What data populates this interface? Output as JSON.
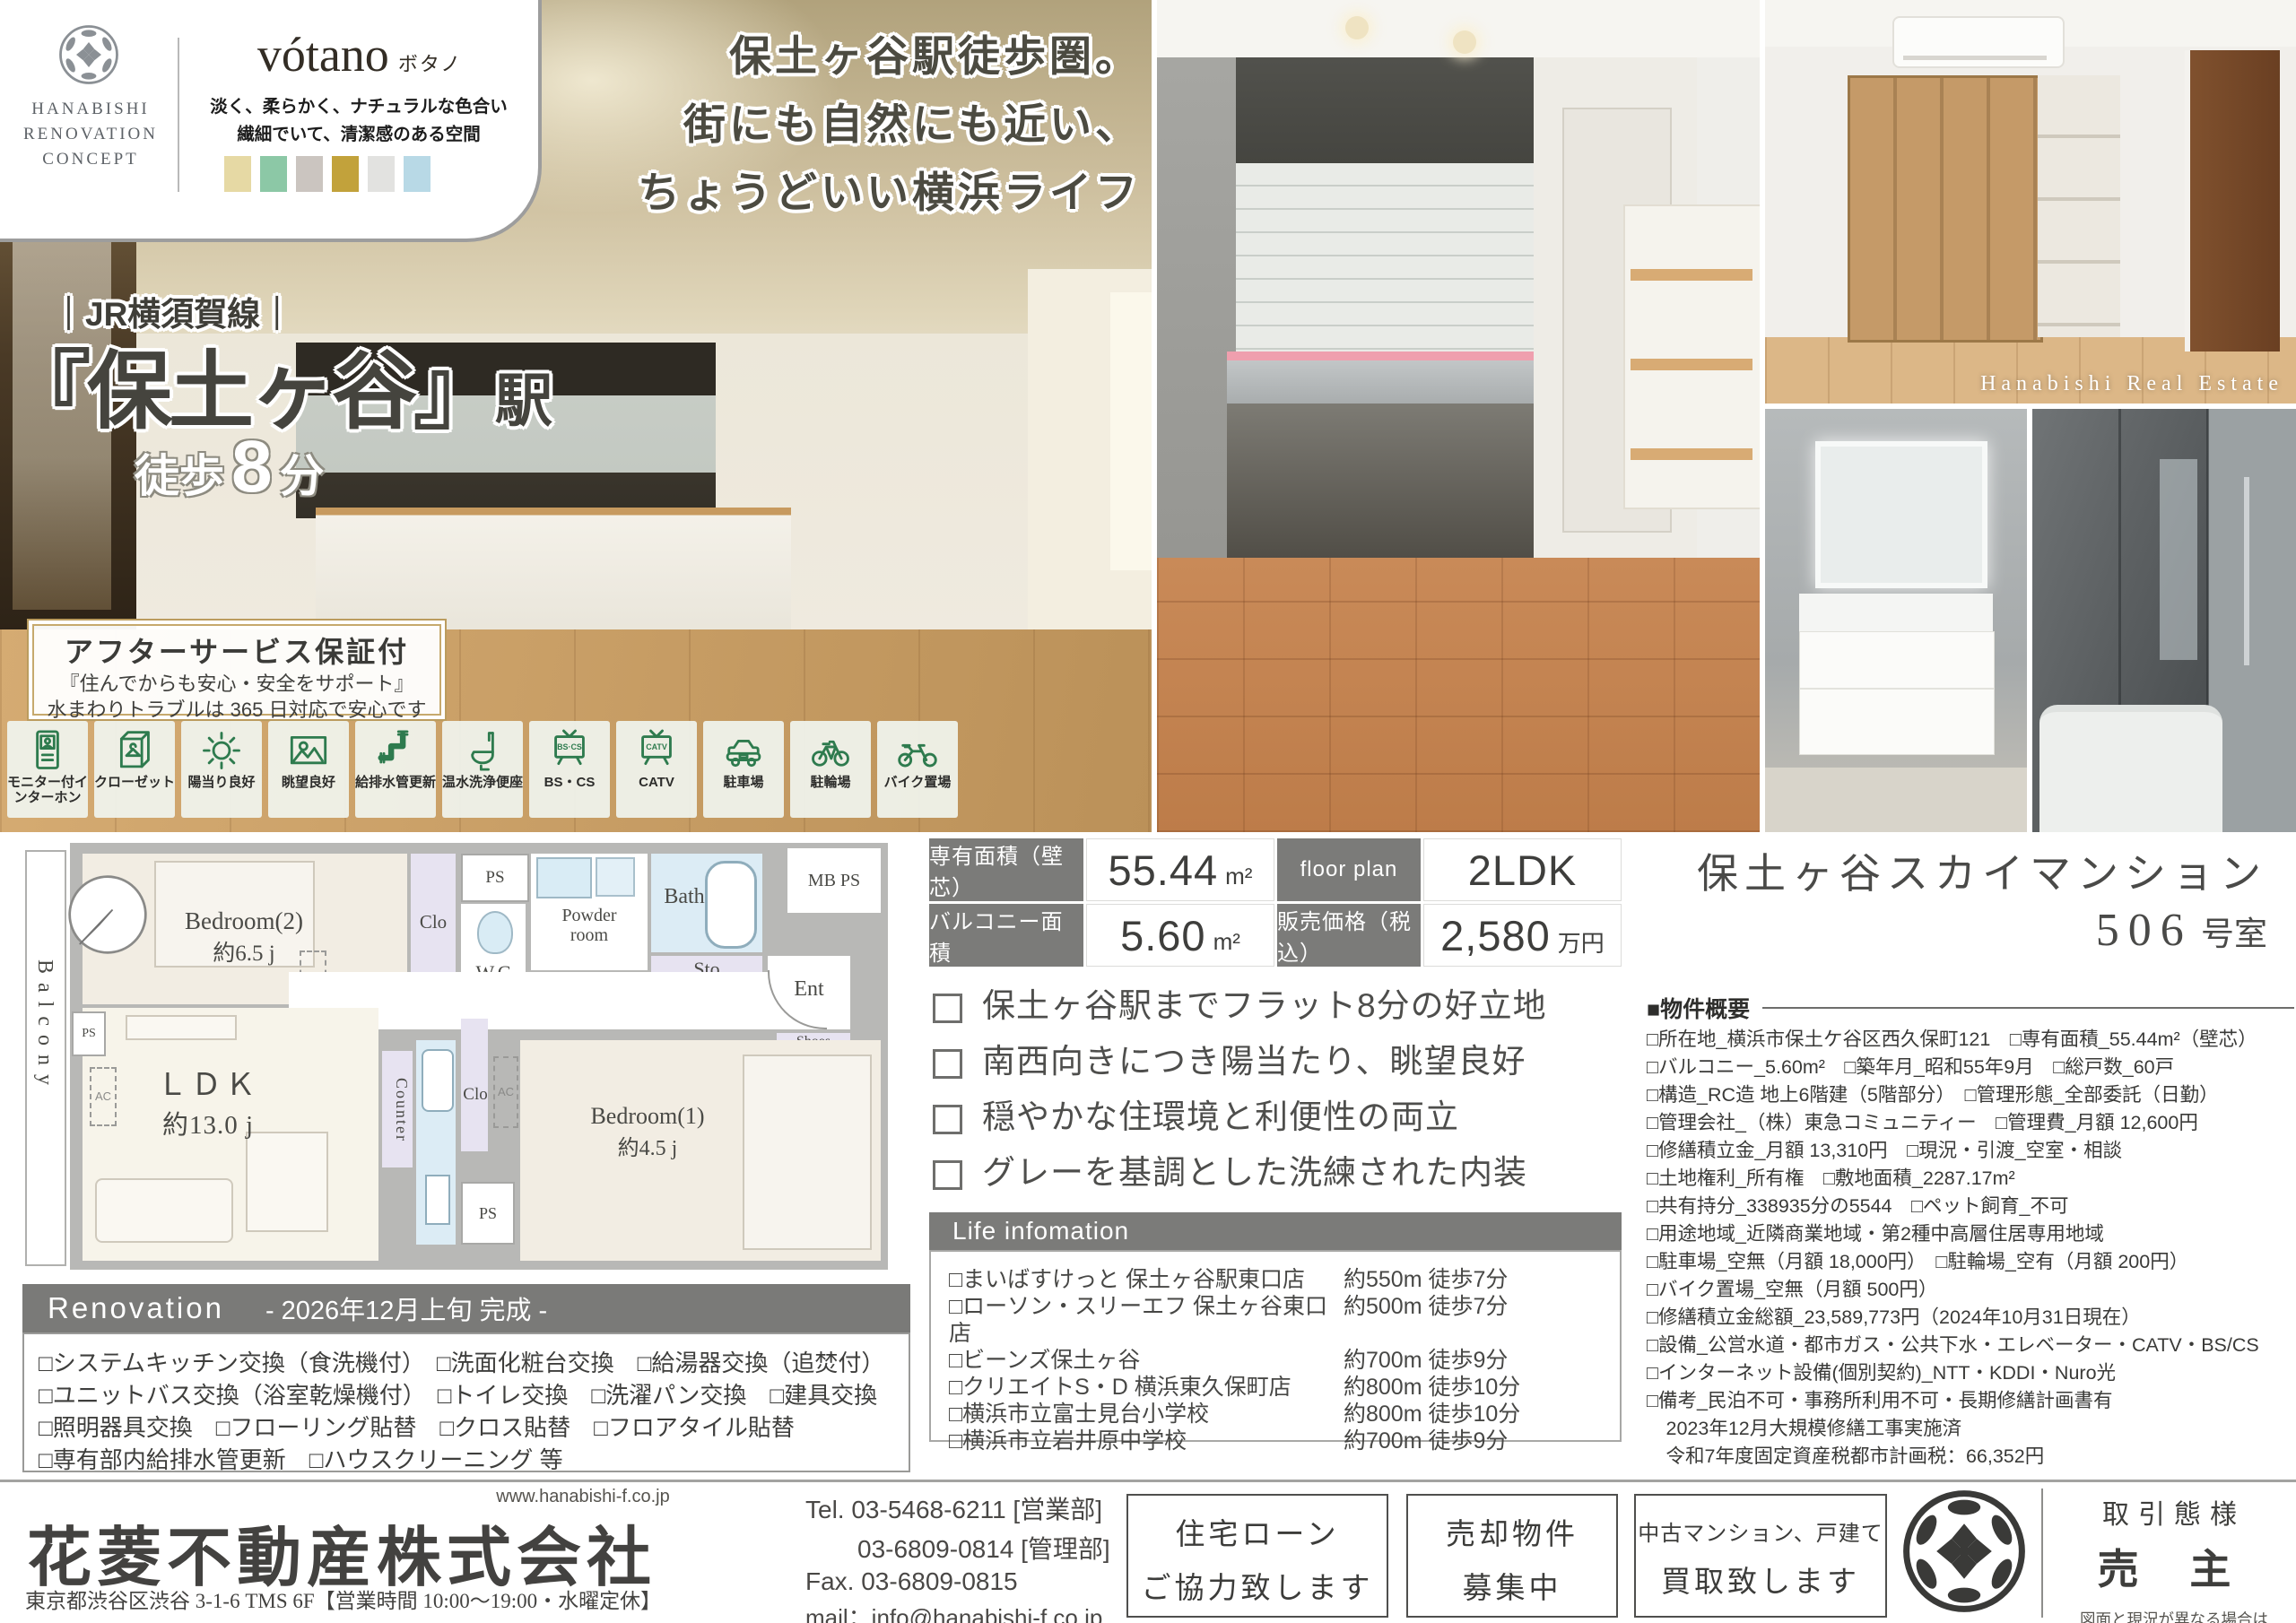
{
  "brand": {
    "logo_lines": [
      "HANABISHI",
      "RENOVATION",
      "CONCEPT"
    ],
    "concept_name": "vótano",
    "concept_kana": "ボタノ",
    "tagline1": "淡く、柔らかく、ナチュラルな色合い",
    "tagline2": "繊細でいて、清潔感のある空間",
    "swatches": [
      "#e6d9a4",
      "#8cc8a6",
      "#cbc5c0",
      "#c2a23b",
      "#e2e2e0",
      "#b8d9e6"
    ]
  },
  "station": {
    "line": "｜JR横須賀線｜",
    "name": "『保土ヶ谷』",
    "suffix": "駅",
    "walk_prefix": "徒歩",
    "walk_num": "8",
    "walk_suffix": "分"
  },
  "headline": {
    "line1": "保土ヶ谷駅徒歩圏。",
    "line2": "街にも自然にも近い、",
    "line3": "ちょうどいい横浜ライフ"
  },
  "warranty": {
    "title": "アフターサービス保証付",
    "sub1": "『住んでからも安心・安全をサポート』",
    "sub2": "水まわりトラブルは 365 日対応で安心です"
  },
  "feature_icons": [
    {
      "label": "モニター付インターホン",
      "icon": "intercom-icon"
    },
    {
      "label": "クローゼット",
      "icon": "closet-icon"
    },
    {
      "label": "陽当り良好",
      "icon": "sun-icon"
    },
    {
      "label": "眺望良好",
      "icon": "view-icon"
    },
    {
      "label": "給排水管更新",
      "icon": "pipe-icon"
    },
    {
      "label": "温水洗浄便座",
      "icon": "toilet-icon"
    },
    {
      "label": "BS・CS",
      "icon": "bscs-tv-icon",
      "tv_text": "BS·CS"
    },
    {
      "label": "CATV",
      "icon": "catv-tv-icon",
      "tv_text": "CATV"
    },
    {
      "label": "駐車場",
      "icon": "car-icon"
    },
    {
      "label": "駐輪場",
      "icon": "bicycle-icon"
    },
    {
      "label": "バイク置場",
      "icon": "motorcycle-icon"
    }
  ],
  "photo_watermark": "Hanabishi Real Estate",
  "floorplan": {
    "balcony": "Balcony",
    "bedroom2": "Bedroom(2)",
    "bedroom2_size": "約6.5 j",
    "clo": "Clo",
    "ps": "PS",
    "wc": "W.C",
    "powder1": "Powder",
    "powder2": "room",
    "bath": "Bath",
    "sto": "Sto",
    "mbps": "MB PS",
    "ent": "Ent",
    "shoes1": "Shoes",
    "shoes2": "box",
    "ldk": "ＬＤＫ",
    "ldk_size": "約13.0 j",
    "counter": "Counter",
    "clo2": "Clo",
    "ac": "AC",
    "bedroom1": "Bedroom(1)",
    "bedroom1_size": "約4.5 j"
  },
  "renovation": {
    "title": "Renovation",
    "subtitle": "- 2026年12月上旬 完成 -",
    "rows": [
      "□システムキッチン交換（食洗機付）　□洗面化粧台交換　□給湯器交換（追焚付）",
      "□ユニットバス交換（浴室乾燥機付）　□トイレ交換　□洗濯パン交換　□建具交換",
      "□照明器具交換　□フローリング貼替　□クロス貼替　□フロアタイル貼替",
      "□専有部内給排水管更新　□ハウスクリーニング 等"
    ]
  },
  "specs": {
    "area_label": "専有面積（壁芯）",
    "area_value": "55.44",
    "area_unit": "m²",
    "plan_label": "floor plan",
    "plan_value": "2LDK",
    "balcony_label": "バルコニー面積",
    "balcony_value": "5.60",
    "balcony_unit": "m²",
    "price_label": "販売価格（税込）",
    "price_value": "2,580",
    "price_unit": "万円"
  },
  "selling_points": [
    "保土ヶ谷駅までフラット8分の好立地",
    "南西向きにつき陽当たり、眺望良好",
    "穏やかな住環境と利便性の両立",
    "グレーを基調とした洗練された内装"
  ],
  "life_info": {
    "title": "Life infomation",
    "items": [
      {
        "name": "□まいばすけっと 保土ヶ谷駅東口店",
        "distance": "約550m 徒歩7分"
      },
      {
        "name": "□ローソン・スリーエフ 保土ヶ谷東口店",
        "distance": "約500m 徒歩7分"
      },
      {
        "name": "□ビーンズ保土ヶ谷",
        "distance": "約700m 徒歩9分"
      },
      {
        "name": "□クリエイトS・D 横浜東久保町店",
        "distance": "約800m 徒歩10分"
      },
      {
        "name": "□横浜市立富士見台小学校",
        "distance": "約800m 徒歩10分"
      },
      {
        "name": "□横浜市立岩井原中学校",
        "distance": "約700m 徒歩9分"
      }
    ]
  },
  "property": {
    "name": "保土ヶ谷スカイマンション",
    "room_num": "506",
    "room_suffix": " 号室",
    "overview_title": "■物件概要",
    "lines": [
      "□所在地_横浜市保土ケ谷区西久保町121　□専有面積_55.44m²（壁芯）",
      "□バルコニー_5.60m²　□築年月_昭和55年9月　□総戸数_60戸",
      "□構造_RC造 地上6階建（5階部分）　□管理形態_全部委託（日勤）",
      "□管理会社_（株）東急コミュニティー　□管理費_月額 12,600円",
      "□修繕積立金_月額 13,310円　□現況・引渡_空室・相談",
      "□土地権利_所有権　□敷地面積_2287.17m²",
      "□共有持分_338935分の5544　□ペット飼育_不可",
      "□用途地域_近隣商業地域・第2種中高層住居専用地域",
      "□駐車場_空無（月額 18,000円）　□駐輪場_空有（月額 200円）",
      "□バイク置場_空無（月額 500円）",
      "□修繕積立金総額_23,589,773円（2024年10月31日現在）",
      "□設備_公営水道・都市ガス・公共下水・エレベーター・CATV・BS/CS",
      "□インターネット設備(個別契約)_NTT・KDDI・Nuro光",
      "□備考_民泊不可・事務所利用不可・長期修繕計画書有",
      "　2023年12月大規模修繕工事実施済",
      "　令和7年度固定資産税都市計画税：66,352円"
    ]
  },
  "footer": {
    "url": "www.hanabishi-f.co.jp",
    "company": "花菱不動産株式会社",
    "address": "東京都渋谷区渋谷 3-1-6 TMS 6F【営業時間 10:00～19:00・水曜定休】",
    "tel1": "Tel. 03-5468-6211 [営業部]",
    "tel2": "03-6809-0814 [管理部]",
    "fax": "Fax. 03-6809-0815",
    "mail": "mail：info@hanabishi-f.co.jp",
    "box1_line1": "住宅ローン",
    "box1_line2": "ご協力致します",
    "box2_line1": "売却物件",
    "box2_line2": "募集中",
    "box3_line1": "中古マンション、戸建て",
    "box3_line2": "買取致します",
    "dealing_label": "取引態様",
    "dealing_value": "売 主",
    "note1": "図面と現況が異なる場合は",
    "note2": "現況を優先いたします。"
  }
}
